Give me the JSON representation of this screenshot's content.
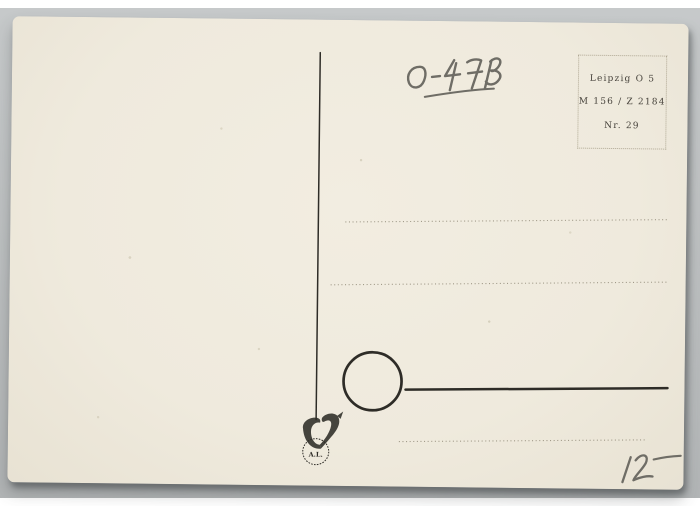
{
  "postcard": {
    "handwritten_code": "O-4713",
    "handwritten_price": "12 –",
    "stamp_box": {
      "city_line": "Leipzig O 5",
      "catalog_line": "M 156 / Z 2184",
      "number_line": "Nr. 29"
    },
    "publisher_mark": {
      "initials": "A.L."
    }
  },
  "colors": {
    "backdrop": "#bfc2c3",
    "card": "#efeadd",
    "ink": "#2e2c27",
    "pencil": "#6f6d66",
    "dots": "#948d7b",
    "boxline": "#b0a894",
    "stamptext": "#46423b"
  }
}
